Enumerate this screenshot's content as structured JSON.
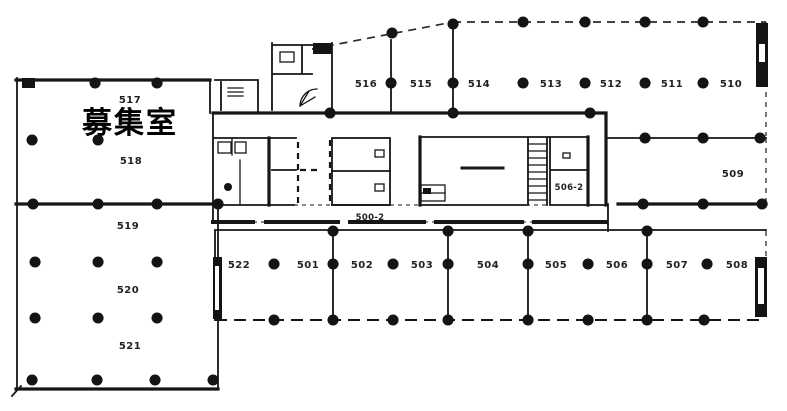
{
  "colors": {
    "ink": "#161616",
    "background": "#ffffff"
  },
  "plan": {
    "vacancy_label": "募集室",
    "rooms": [
      {
        "id": "517"
      },
      {
        "id": "518"
      },
      {
        "id": "519"
      },
      {
        "id": "520"
      },
      {
        "id": "521"
      },
      {
        "id": "516"
      },
      {
        "id": "515"
      },
      {
        "id": "514"
      },
      {
        "id": "513"
      },
      {
        "id": "512"
      },
      {
        "id": "511"
      },
      {
        "id": "510"
      },
      {
        "id": "509"
      },
      {
        "id": "522"
      },
      {
        "id": "501"
      },
      {
        "id": "502"
      },
      {
        "id": "503"
      },
      {
        "id": "504"
      },
      {
        "id": "505"
      },
      {
        "id": "506"
      },
      {
        "id": "507"
      },
      {
        "id": "508"
      }
    ],
    "core_labels": [
      {
        "id": "500-2"
      },
      {
        "id": "506-2"
      }
    ]
  }
}
